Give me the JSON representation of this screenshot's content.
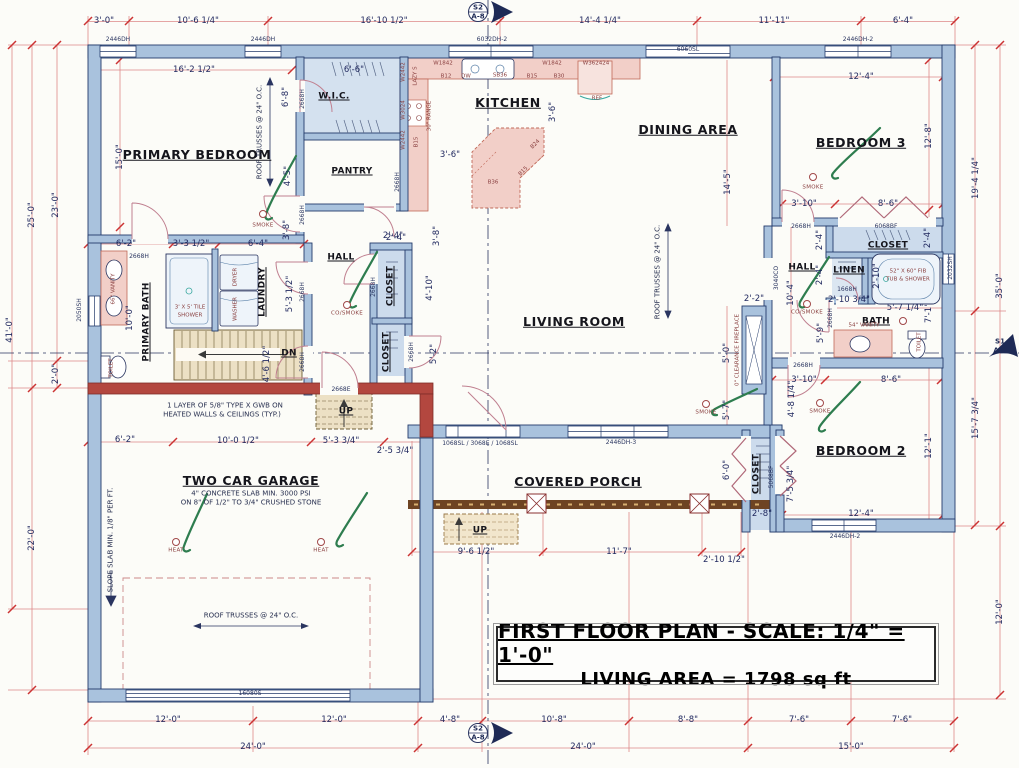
{
  "title_block": {
    "line1": "FIRST FLOOR PLAN - SCALE: 1/4\" = 1'-0\"",
    "line2": "LIVING AREA = 1798 sq ft"
  },
  "colors": {
    "wall": "#a9c2dd",
    "wall_outline": "#243b6b",
    "firewall": "#b3473f",
    "counter_pink": "#f2cfc8",
    "dimension_line": "#dd8888",
    "tick_red": "#cc3333",
    "label_navy": "#222a60",
    "green_arrow": "#2e7d4f",
    "porch_band": "#6e4423",
    "stair_tan": "#ece0c4",
    "section_marker": "#1e2a55"
  },
  "labels": [
    {
      "t": "3'-0\"",
      "x": 104,
      "y": 21
    },
    {
      "t": "10'-6 1/4\"",
      "x": 198,
      "y": 21
    },
    {
      "t": "16'-10 1/2\"",
      "x": 384,
      "y": 21
    },
    {
      "t": "14'-4 1/4\"",
      "x": 600,
      "y": 21
    },
    {
      "t": "11'-11\"",
      "x": 774,
      "y": 21
    },
    {
      "t": "6'-4\"",
      "x": 903,
      "y": 21
    },
    {
      "t": "2446DH",
      "x": 118,
      "y": 40,
      "c": "tiny"
    },
    {
      "t": "2446DH",
      "x": 263,
      "y": 40,
      "c": "tiny"
    },
    {
      "t": "6032DH-2",
      "x": 492,
      "y": 40,
      "c": "tiny"
    },
    {
      "t": "6060SL",
      "x": 688,
      "y": 50,
      "c": "tiny"
    },
    {
      "t": "2446DH-2",
      "x": 858,
      "y": 40,
      "c": "tiny"
    },
    {
      "t": "41'-0\"",
      "x": 10,
      "y": 330,
      "r": -90
    },
    {
      "t": "25'-0\"",
      "x": 32,
      "y": 215,
      "r": -90
    },
    {
      "t": "23'-0\"",
      "x": 56,
      "y": 205,
      "r": -90
    },
    {
      "t": "2'-0\"",
      "x": 56,
      "y": 374,
      "r": -90
    },
    {
      "t": "22'-0\"",
      "x": 32,
      "y": 538,
      "r": -90
    },
    {
      "t": "2050SH",
      "x": 80,
      "y": 310,
      "r": -90,
      "c": "tiny"
    },
    {
      "t": "19'-4 1/4\"",
      "x": 976,
      "y": 178,
      "r": -90
    },
    {
      "t": "35'-0\"",
      "x": 1000,
      "y": 286,
      "r": -90
    },
    {
      "t": "15'-7 3/4\"",
      "x": 976,
      "y": 418,
      "r": -90
    },
    {
      "t": "12'-0\"",
      "x": 1000,
      "y": 612,
      "r": -90
    },
    {
      "t": "2032SH",
      "x": 951,
      "y": 268,
      "r": -90,
      "c": "tiny"
    },
    {
      "t": "12'-0\"",
      "x": 168,
      "y": 720
    },
    {
      "t": "12'-0\"",
      "x": 334,
      "y": 720
    },
    {
      "t": "4'-8\"",
      "x": 450,
      "y": 720
    },
    {
      "t": "10'-8\"",
      "x": 554,
      "y": 720
    },
    {
      "t": "8'-8\"",
      "x": 688,
      "y": 720
    },
    {
      "t": "7'-6\"",
      "x": 799,
      "y": 720
    },
    {
      "t": "7'-6\"",
      "x": 902,
      "y": 720
    },
    {
      "t": "24'-0\"",
      "x": 253,
      "y": 747
    },
    {
      "t": "24'-0\"",
      "x": 583,
      "y": 747
    },
    {
      "t": "15'-0\"",
      "x": 851,
      "y": 747
    },
    {
      "t": "S2",
      "x": 478,
      "y": 8,
      "c": "sec"
    },
    {
      "t": "A-8",
      "x": 478,
      "y": 17,
      "c": "sec"
    },
    {
      "t": "S2",
      "x": 478,
      "y": 729,
      "c": "sec"
    },
    {
      "t": "A-8",
      "x": 478,
      "y": 738,
      "c": "sec"
    },
    {
      "t": "S1",
      "x": 1000,
      "y": 342,
      "c": "sec"
    },
    {
      "t": "A-7",
      "x": 1000,
      "y": 351,
      "c": "sec"
    },
    {
      "t": "16'-2 1/2\"",
      "x": 194,
      "y": 70
    },
    {
      "t": "PRIMARY BEDROOM",
      "x": 197,
      "y": 155,
      "c": "room"
    },
    {
      "t": "15'-0\"",
      "x": 120,
      "y": 157,
      "r": -90
    },
    {
      "t": "ROOF TRUSSES @ 24\" O.C.",
      "x": 260,
      "y": 132,
      "r": -90,
      "c": "note"
    },
    {
      "t": "6'-8\"",
      "x": 286,
      "y": 97,
      "r": -90
    },
    {
      "t": "W.I.C.",
      "x": 334,
      "y": 97,
      "c": "room-sm"
    },
    {
      "t": "6'-6\"",
      "x": 354,
      "y": 70
    },
    {
      "t": "PANTRY",
      "x": 352,
      "y": 172,
      "c": "room-sm"
    },
    {
      "t": "4'-5\"",
      "x": 288,
      "y": 176,
      "r": -90
    },
    {
      "t": "SMOKE",
      "x": 263,
      "y": 226,
      "c": "fixture"
    },
    {
      "t": "3'-8\"",
      "x": 287,
      "y": 230,
      "r": -90
    },
    {
      "t": "2'-4\"",
      "x": 393,
      "y": 236
    },
    {
      "t": "2668H",
      "x": 303,
      "y": 99,
      "r": -90,
      "c": "tiny"
    },
    {
      "t": "2668H",
      "x": 303,
      "y": 215,
      "r": -90,
      "c": "tiny"
    },
    {
      "t": "2668H",
      "x": 398,
      "y": 182,
      "r": -90,
      "c": "tiny"
    },
    {
      "t": "KITCHEN",
      "x": 508,
      "y": 103,
      "c": "room"
    },
    {
      "t": "3'-6\"",
      "x": 553,
      "y": 112,
      "r": -90
    },
    {
      "t": "3'-6\"",
      "x": 450,
      "y": 155
    },
    {
      "t": "DINING AREA",
      "x": 688,
      "y": 130,
      "c": "room"
    },
    {
      "t": "14'-5\"",
      "x": 728,
      "y": 182,
      "r": -90
    },
    {
      "t": "W2442",
      "x": 404,
      "y": 72,
      "r": -90,
      "c": "cab"
    },
    {
      "t": "LAZY S",
      "x": 416,
      "y": 76,
      "r": -90,
      "c": "cab"
    },
    {
      "t": "W3024",
      "x": 404,
      "y": 110,
      "r": -90,
      "c": "cab"
    },
    {
      "t": "30\" RANGE",
      "x": 430,
      "y": 116,
      "r": -90,
      "c": "cab"
    },
    {
      "t": "W2442",
      "x": 404,
      "y": 140,
      "r": -90,
      "c": "cab"
    },
    {
      "t": "B15",
      "x": 417,
      "y": 142,
      "r": -90,
      "c": "cab"
    },
    {
      "t": "W1842",
      "x": 443,
      "y": 64,
      "c": "cab"
    },
    {
      "t": "B12",
      "x": 446,
      "y": 77,
      "c": "cab"
    },
    {
      "t": "DW",
      "x": 466,
      "y": 77,
      "c": "cab"
    },
    {
      "t": "SB36",
      "x": 500,
      "y": 76,
      "c": "cab"
    },
    {
      "t": "B15",
      "x": 532,
      "y": 77,
      "c": "cab"
    },
    {
      "t": "B30",
      "x": 559,
      "y": 77,
      "c": "cab"
    },
    {
      "t": "W1842",
      "x": 552,
      "y": 64,
      "c": "cab"
    },
    {
      "t": "W362424",
      "x": 596,
      "y": 64,
      "c": "cab"
    },
    {
      "t": "REF",
      "x": 597,
      "y": 99,
      "c": "cab"
    },
    {
      "t": "B24",
      "x": 536,
      "y": 145,
      "r": -45,
      "c": "cab"
    },
    {
      "t": "B15",
      "x": 524,
      "y": 172,
      "r": -45,
      "c": "cab"
    },
    {
      "t": "B36",
      "x": 493,
      "y": 183,
      "c": "cab"
    },
    {
      "t": "12'-4\"",
      "x": 861,
      "y": 77
    },
    {
      "t": "BEDROOM 3",
      "x": 861,
      "y": 143,
      "c": "room"
    },
    {
      "t": "12'-8\"",
      "x": 929,
      "y": 136,
      "r": -90
    },
    {
      "t": "SMOKE",
      "x": 813,
      "y": 188,
      "c": "fixture"
    },
    {
      "t": "3'-10\"",
      "x": 804,
      "y": 204
    },
    {
      "t": "8'-6\"",
      "x": 888,
      "y": 204
    },
    {
      "t": "2668H",
      "x": 801,
      "y": 227,
      "c": "tiny"
    },
    {
      "t": "6068BF",
      "x": 886,
      "y": 227,
      "c": "tiny"
    },
    {
      "t": "CLOSET",
      "x": 888,
      "y": 246,
      "c": "room-sm"
    },
    {
      "t": "2'-4\"",
      "x": 820,
      "y": 240,
      "r": -90
    },
    {
      "t": "2'-4\"",
      "x": 928,
      "y": 238,
      "r": -90
    },
    {
      "t": "HALL",
      "x": 802,
      "y": 268,
      "c": "room-sm"
    },
    {
      "t": "LINEN",
      "x": 849,
      "y": 271,
      "c": "room-sm"
    },
    {
      "t": "2'-10\"",
      "x": 877,
      "y": 276,
      "r": -90
    },
    {
      "t": "52\" X 60\" FIB",
      "x": 908,
      "y": 272,
      "c": "cab"
    },
    {
      "t": "TUB & SHOWER",
      "x": 908,
      "y": 280,
      "c": "cab"
    },
    {
      "t": "10'-4\"",
      "x": 791,
      "y": 293,
      "r": -90
    },
    {
      "t": "2'-4\"",
      "x": 820,
      "y": 275,
      "r": -90
    },
    {
      "t": "1668H",
      "x": 847,
      "y": 290,
      "c": "tiny"
    },
    {
      "t": "2'-10 3/4\"",
      "x": 849,
      "y": 300
    },
    {
      "t": "CO/SMOKE",
      "x": 807,
      "y": 313,
      "c": "fixture"
    },
    {
      "t": "5'-7 1/4\"",
      "x": 905,
      "y": 308
    },
    {
      "t": "7'-1\"",
      "x": 929,
      "y": 313,
      "r": -90
    },
    {
      "t": "BATH",
      "x": 876,
      "y": 322,
      "c": "room-sm"
    },
    {
      "t": "5'-9\"",
      "x": 821,
      "y": 333,
      "r": -90
    },
    {
      "t": "2668H",
      "x": 831,
      "y": 318,
      "r": -90,
      "c": "tiny"
    },
    {
      "t": "54\" VANITY",
      "x": 864,
      "y": 326,
      "c": "cab"
    },
    {
      "t": "TOILET",
      "x": 920,
      "y": 342,
      "r": -90,
      "c": "cab"
    },
    {
      "t": "3040CO",
      "x": 777,
      "y": 278,
      "r": -90,
      "c": "tiny"
    },
    {
      "t": "2668H",
      "x": 803,
      "y": 366,
      "c": "tiny"
    },
    {
      "t": "3'-10\"",
      "x": 804,
      "y": 380
    },
    {
      "t": "8'-6\"",
      "x": 891,
      "y": 380
    },
    {
      "t": "4'-8 1/4\"",
      "x": 792,
      "y": 399,
      "r": -90
    },
    {
      "t": "SMOKE",
      "x": 820,
      "y": 412,
      "c": "fixture"
    },
    {
      "t": "BEDROOM 2",
      "x": 861,
      "y": 451,
      "c": "room"
    },
    {
      "t": "12'-1\"",
      "x": 929,
      "y": 446,
      "r": -90
    },
    {
      "t": "7'-5 3/4\"",
      "x": 791,
      "y": 484,
      "r": -90
    },
    {
      "t": "5068BF",
      "x": 772,
      "y": 477,
      "r": -90,
      "c": "tiny"
    },
    {
      "t": "12'-4\"",
      "x": 861,
      "y": 514
    },
    {
      "t": "2446DH-2",
      "x": 845,
      "y": 537,
      "c": "tiny"
    },
    {
      "t": "1068SL / 3068E / 1068SL",
      "x": 480,
      "y": 444,
      "c": "tiny"
    },
    {
      "t": "2446DH-3",
      "x": 621,
      "y": 443,
      "c": "tiny"
    },
    {
      "t": "COVERED PORCH",
      "x": 578,
      "y": 482,
      "c": "room"
    },
    {
      "t": "6'-0\"",
      "x": 727,
      "y": 470,
      "r": -90
    },
    {
      "t": "CLOSET",
      "x": 757,
      "y": 474,
      "r": -90,
      "c": "room-sm"
    },
    {
      "t": "UP",
      "x": 480,
      "y": 531,
      "c": "room-sm"
    },
    {
      "t": "9'-6 1/2\"",
      "x": 476,
      "y": 552
    },
    {
      "t": "11'-7\"",
      "x": 619,
      "y": 552
    },
    {
      "t": "2'-10 1/2\"",
      "x": 724,
      "y": 560
    },
    {
      "t": "2'-8\"",
      "x": 762,
      "y": 514
    },
    {
      "t": "HALL",
      "x": 341,
      "y": 258,
      "c": "room-sm"
    },
    {
      "t": "2'-4\"",
      "x": 396,
      "y": 238
    },
    {
      "t": "3'-8\"",
      "x": 437,
      "y": 236,
      "r": -90
    },
    {
      "t": "CLOSET",
      "x": 391,
      "y": 286,
      "r": -90,
      "c": "room-sm"
    },
    {
      "t": "4'-10\"",
      "x": 430,
      "y": 288,
      "r": -90
    },
    {
      "t": "CO/SMOKE",
      "x": 347,
      "y": 314,
      "c": "fixture"
    },
    {
      "t": "CLOSET",
      "x": 387,
      "y": 352,
      "r": -90,
      "c": "room-sm"
    },
    {
      "t": "5'-2\"",
      "x": 434,
      "y": 354,
      "r": -90
    },
    {
      "t": "2668H",
      "x": 374,
      "y": 287,
      "r": -90,
      "c": "tiny"
    },
    {
      "t": "2668H",
      "x": 412,
      "y": 352,
      "r": -90,
      "c": "tiny"
    },
    {
      "t": "2668E",
      "x": 341,
      "y": 390,
      "c": "tiny"
    },
    {
      "t": "UP",
      "x": 346,
      "y": 412,
      "c": "room-sm"
    },
    {
      "t": "LIVING ROOM",
      "x": 574,
      "y": 322,
      "c": "room"
    },
    {
      "t": "ROOF TRUSSES @ 24\" O.C.",
      "x": 658,
      "y": 272,
      "r": -90,
      "c": "note"
    },
    {
      "t": "5'-0\"",
      "x": 727,
      "y": 353,
      "r": -90
    },
    {
      "t": "0\" CLEARANCE FIREPLACE",
      "x": 738,
      "y": 350,
      "r": -90,
      "c": "cab"
    },
    {
      "t": "5'-7\"",
      "x": 727,
      "y": 410,
      "r": -90
    },
    {
      "t": "SMOKE",
      "x": 706,
      "y": 413,
      "c": "fixture"
    },
    {
      "t": "2'-2\"",
      "x": 754,
      "y": 299
    },
    {
      "t": "6'-2\"",
      "x": 126,
      "y": 244
    },
    {
      "t": "3'-3 1/2\"",
      "x": 191,
      "y": 244
    },
    {
      "t": "6'-4\"",
      "x": 258,
      "y": 244
    },
    {
      "t": "2668H",
      "x": 139,
      "y": 257,
      "c": "tiny"
    },
    {
      "t": "66\" VANITY",
      "x": 114,
      "y": 289,
      "r": -90,
      "c": "cab"
    },
    {
      "t": "PRIMARY BATH",
      "x": 147,
      "y": 322,
      "r": -90,
      "c": "room-sm"
    },
    {
      "t": "10'-0\"",
      "x": 130,
      "y": 318,
      "r": -90
    },
    {
      "t": "3' X 5' TILE",
      "x": 190,
      "y": 308,
      "c": "cab"
    },
    {
      "t": "SHOWER",
      "x": 190,
      "y": 316,
      "c": "cab"
    },
    {
      "t": "DRYER",
      "x": 236,
      "y": 277,
      "r": -90,
      "c": "cab"
    },
    {
      "t": "WASHER",
      "x": 236,
      "y": 309,
      "r": -90,
      "c": "cab"
    },
    {
      "t": "LAUNDRY",
      "x": 263,
      "y": 292,
      "r": -90,
      "c": "room-sm"
    },
    {
      "t": "5'-3 1/2\"",
      "x": 290,
      "y": 294,
      "r": -90
    },
    {
      "t": "2668H",
      "x": 303,
      "y": 292,
      "r": -90,
      "c": "tiny"
    },
    {
      "t": "DN",
      "x": 289,
      "y": 354,
      "c": "room-sm"
    },
    {
      "t": "4'-6 1/2\"",
      "x": 267,
      "y": 364,
      "r": -90
    },
    {
      "t": "2668H",
      "x": 303,
      "y": 362,
      "r": -90,
      "c": "tiny"
    },
    {
      "t": "TOILET",
      "x": 112,
      "y": 368,
      "r": -90,
      "c": "cab"
    },
    {
      "t": "1 LAYER OF 5/8\" TYPE X GWB ON",
      "x": 225,
      "y": 406,
      "c": "note"
    },
    {
      "t": "HEATED WALLS & CEILINGS (TYP.)",
      "x": 222,
      "y": 415,
      "c": "note"
    },
    {
      "t": "6'-2\"",
      "x": 125,
      "y": 440
    },
    {
      "t": "10'-0 1/2\"",
      "x": 238,
      "y": 441
    },
    {
      "t": "5'-3 3/4\"",
      "x": 341,
      "y": 441
    },
    {
      "t": "2'-5 3/4\"",
      "x": 395,
      "y": 451
    },
    {
      "t": "TWO CAR GARAGE",
      "x": 251,
      "y": 481,
      "c": "room"
    },
    {
      "t": "4\" CONCRETE SLAB MIN. 3000 PSI",
      "x": 251,
      "y": 494,
      "c": "note"
    },
    {
      "t": "ON 8\" OF 1/2\" TO 3/4\" CRUSHED STONE",
      "x": 251,
      "y": 503,
      "c": "note"
    },
    {
      "t": "SLOPE SLAB MIN. 1/8\" PER FT.",
      "x": 111,
      "y": 540,
      "r": -90,
      "c": "note"
    },
    {
      "t": "HEAT",
      "x": 176,
      "y": 551,
      "c": "fixture"
    },
    {
      "t": "HEAT",
      "x": 321,
      "y": 551,
      "c": "fixture"
    },
    {
      "t": "ROOF TRUSSES @ 24\" O.C.",
      "x": 251,
      "y": 616,
      "c": "note"
    },
    {
      "t": "16080S",
      "x": 250,
      "y": 694,
      "c": "tiny"
    }
  ]
}
